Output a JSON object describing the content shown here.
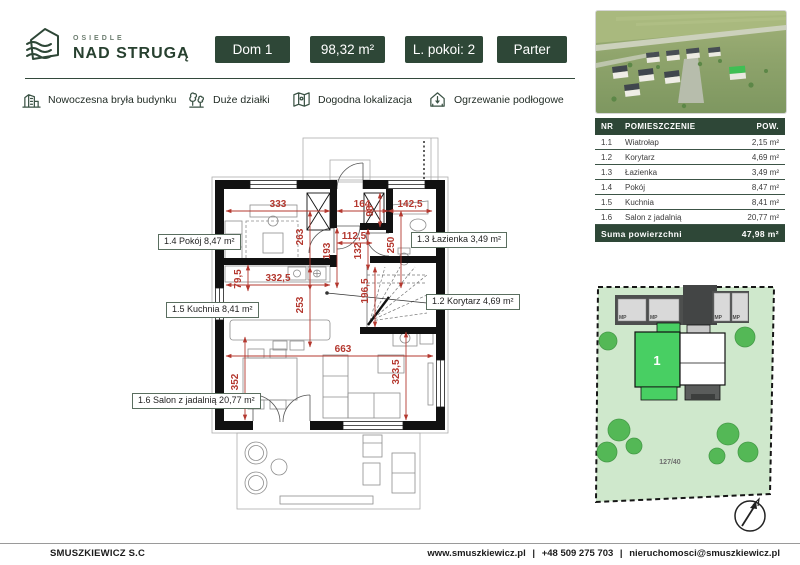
{
  "header": {
    "logo_small": "OSIEDLE",
    "logo_large": "NAD STRUGĄ",
    "badges": [
      "Dom 1",
      "98,32 m²",
      "L. pokoi: 2",
      "Parter"
    ]
  },
  "features": [
    {
      "icon": "building-icon",
      "label": "Nowoczesna bryła budynku"
    },
    {
      "icon": "trees-icon",
      "label": "Duże działki"
    },
    {
      "icon": "map-icon",
      "label": "Dogodna lokalizacja"
    },
    {
      "icon": "floor-heating-icon",
      "label": "Ogrzewanie podłogowe"
    }
  ],
  "floor_plan": {
    "room_labels": [
      {
        "id": "1.4",
        "text": "1.4 Pokój 8,47 m²"
      },
      {
        "id": "1.3",
        "text": "1.3 Łazienka 3,49 m²"
      },
      {
        "id": "1.5",
        "text": "1.5 Kuchnia 8,41 m²"
      },
      {
        "id": "1.2",
        "text": "1.2 Korytarz 4,69 m²"
      },
      {
        "id": "1.6",
        "text": "1.6 Salon z jadalnią 20,77 m²"
      }
    ],
    "dimensions": [
      "333",
      "164",
      "142,5",
      "263",
      "98",
      "112,5",
      "193",
      "132",
      "250",
      "332,5",
      "79,5",
      "253",
      "196,5",
      "663",
      "352",
      "323,5"
    ]
  },
  "rooms_table": {
    "columns": [
      "NR",
      "POMIESZCZENIE",
      "POW."
    ],
    "rows": [
      [
        "1.1",
        "Wiatrołap",
        "2,15 m²"
      ],
      [
        "1.2",
        "Korytarz",
        "4,69 m²"
      ],
      [
        "1.3",
        "Łazienka",
        "3,49 m²"
      ],
      [
        "1.4",
        "Pokój",
        "8,47 m²"
      ],
      [
        "1.5",
        "Kuchnia",
        "8,41 m²"
      ],
      [
        "1.6",
        "Salon z jadalnią",
        "20,77 m²"
      ]
    ],
    "summary_label": "Suma powierzchni",
    "summary_value": "47,98 m²"
  },
  "site_plan": {
    "house_number": "1",
    "plot_number": "127/40",
    "parking_label": "MP"
  },
  "footer": {
    "company": "SMUSZKIEWICZ S.C",
    "links": [
      "www.smuszkiewicz.pl",
      "+48 509 275 703",
      "nieruchomosci@smuszkiewicz.pl"
    ],
    "separator": "|"
  },
  "colors": {
    "brand_green": "#2e4737",
    "dimension_red": "#b4382f",
    "plot_green": "#cfe8cc",
    "house_green": "#48cf63"
  }
}
